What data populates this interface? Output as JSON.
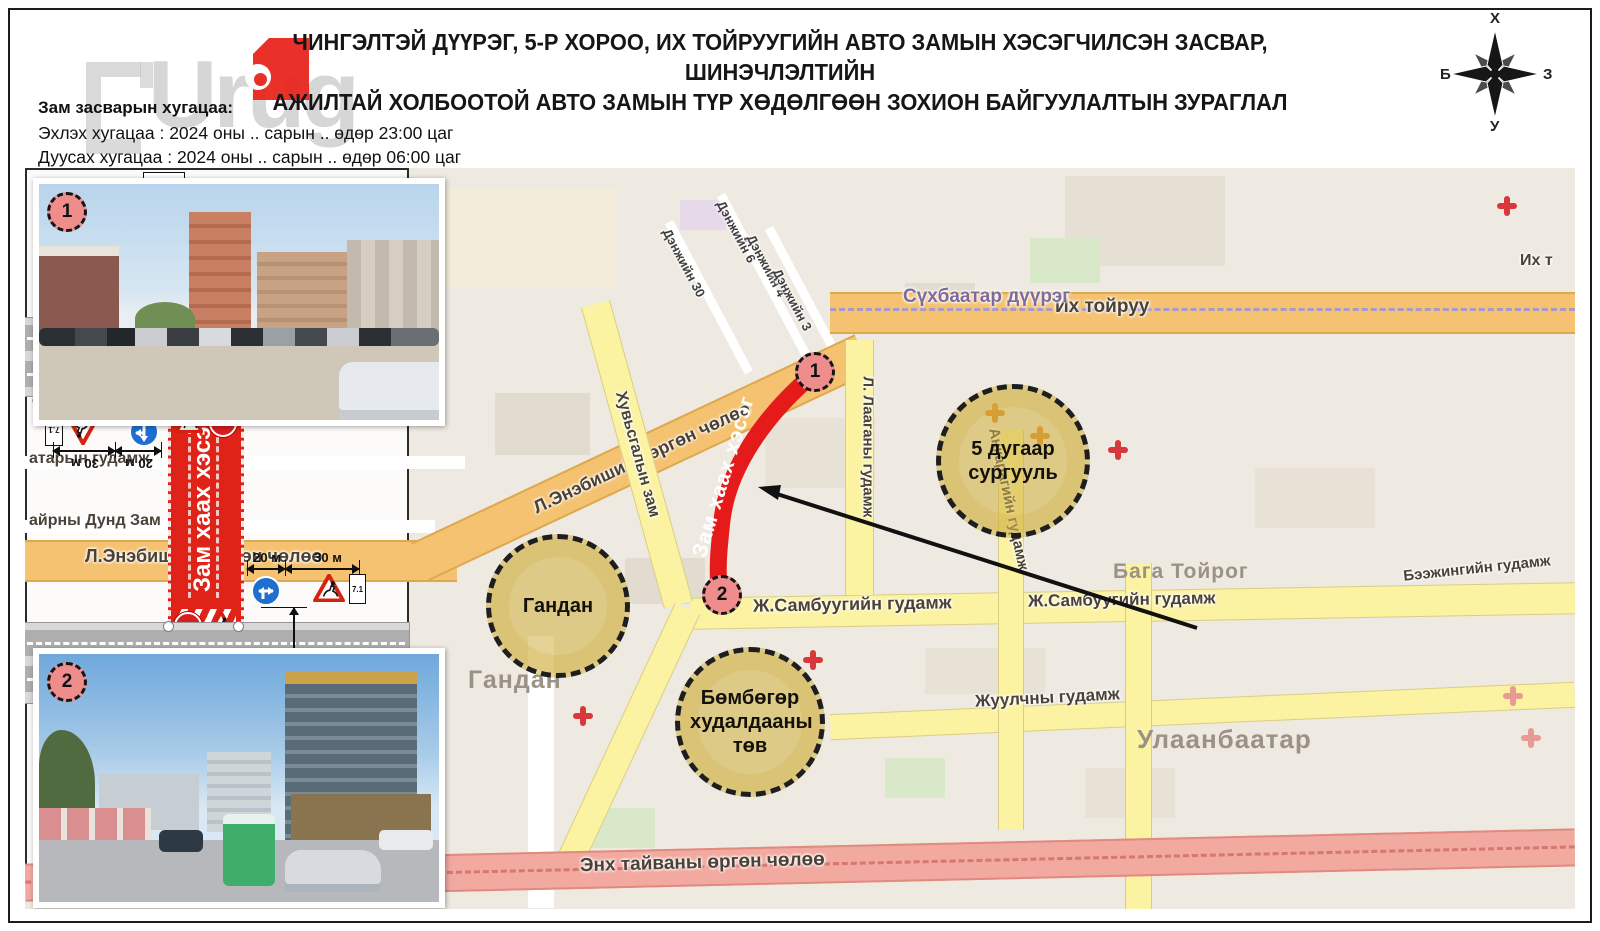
{
  "header": {
    "title_line1": "ЧИНГЭЛТЭЙ ДҮҮРЭГ, 5-Р ХОРОО, ИХ ТОЙРУУГИЙН АВТО ЗАМЫН ХЭСЭГЧИЛСЭН ЗАСВАР, ШИНЭЧЛЭЛТИЙН",
    "title_line2": "АЖИЛТАЙ ХОЛБООТОЙ АВТО ЗАМЫН ТҮР ХӨДӨЛГӨӨН ЗОХИОН БАЙГУУЛАЛТЫН ЗУРАГЛАЛ",
    "watermark": "Urug"
  },
  "schedule": {
    "heading": "Зам засварын хугацаа:",
    "start": "Эхлэх хугацаа : 2024 оны .. сарын .. өдөр 23:00 цаг",
    "end": "Дуусах хугацаа : 2024 оны .. сарын .. өдөр 06:00 цаг"
  },
  "compass": {
    "n": "Х",
    "e": "З",
    "s": "У",
    "w": "Б"
  },
  "map": {
    "streets": {
      "enebish": "Л.Энэбишийн өргөн чөлөө",
      "toiruu": "Их тойруу",
      "toiruu_short": "Их т",
      "sukhbaatar": "Сүхбаатар дүүрэг",
      "sambuu": "Ж.Самбуугийн гудамж",
      "juulchny": "Жуулчны гудамж",
      "enkhtaivan": "Энх тайваны өргөн чөлөө",
      "laagan": "Л. Лааганы гудамж",
      "ankara": "Анкарагийн гудамж",
      "khuvsgal": "Хувьсгалын зам",
      "atar": "атарын гудамж",
      "dund": "айрны Дунд Зам",
      "urguu": "Өргөө гудамж",
      "denj30": "Дэнжийн 30",
      "denj6": "Дэнжийн 6",
      "denj4": "Дэнжийн 4",
      "denj3": "Дэнжийн 3",
      "beijing": "Бээжингийн гудамж"
    },
    "places": {
      "baga_toirog": "Бага Тойрог",
      "gandan_area": "Гандан",
      "ulaanbaatar": "Улаанбаатар"
    },
    "poi": {
      "gandan": "Гандан",
      "school": "5 дугаар сургууль",
      "bumbugur": "Бөмбөгөр худалдааны төв"
    },
    "closure_label": "Зам хаах хэсэг",
    "marker1": "1",
    "marker2": "2"
  },
  "panel": {
    "closure_label": "Зам хаах хэсэг",
    "m100": "100 м",
    "m20": "20 м",
    "m30": "30 м",
    "sign_tri_code": "1.21",
    "sign_plate_code": "7.1",
    "plate_100": "100 м",
    "plate_300": "300 м",
    "sign_blue_code": "4.1.в"
  },
  "photos": {
    "marker1": "1",
    "marker2": "2"
  }
}
